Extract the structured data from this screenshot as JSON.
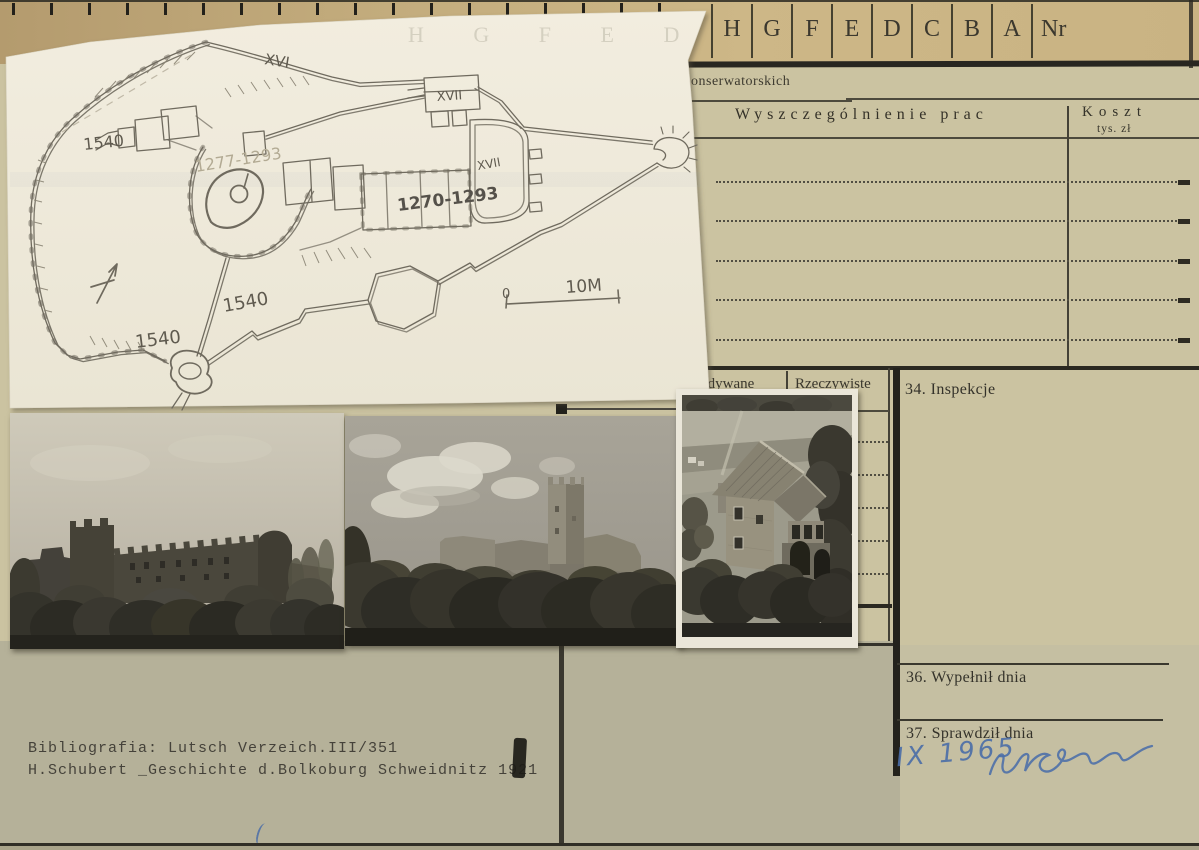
{
  "colors": {
    "card_top": "#c2ab7d",
    "card": "#cbc3a1",
    "card_lower": "#b5b199",
    "paper": "#f1ecdd",
    "ink": "#35332a",
    "pencil": "#6f6a5e",
    "blue_ink": "#4b6ea8"
  },
  "header": {
    "columns": [
      "H",
      "G",
      "F",
      "E",
      "D",
      "C",
      "B",
      "A",
      "Nr"
    ],
    "section_fragment": "onserwatorskich"
  },
  "works_table": {
    "title": "Wyszczególnienie prac",
    "cost_label": "Koszt",
    "cost_unit": "tys. zł"
  },
  "schedule": {
    "planned_label": "Przewidywane",
    "actual_label": "Rzeczywiste"
  },
  "sections": {
    "inspections": "34. Inspekcje",
    "filled": "36. Wypełnił dnia",
    "checked": "37. Sprawdził dnia"
  },
  "handwriting": {
    "date": "IX 1965"
  },
  "plan": {
    "labels": {
      "xvi": "XVI",
      "xvii_north": "XVII",
      "xvii_east": "XVII",
      "faint_date": "1277-1293",
      "main_date": "1270-1293",
      "y1540": [
        "1540",
        "1540",
        "1540"
      ],
      "scale_start": "0",
      "scale_end": "10M",
      "ghost_letters": "H  G  F  E  D  C"
    }
  },
  "bibliography": {
    "line1": "Bibliografia: Lutsch Verzeich.III/351",
    "line2": "H.Schubert _Geschichte d.Bolkoburg Schweidnitz 1921"
  }
}
